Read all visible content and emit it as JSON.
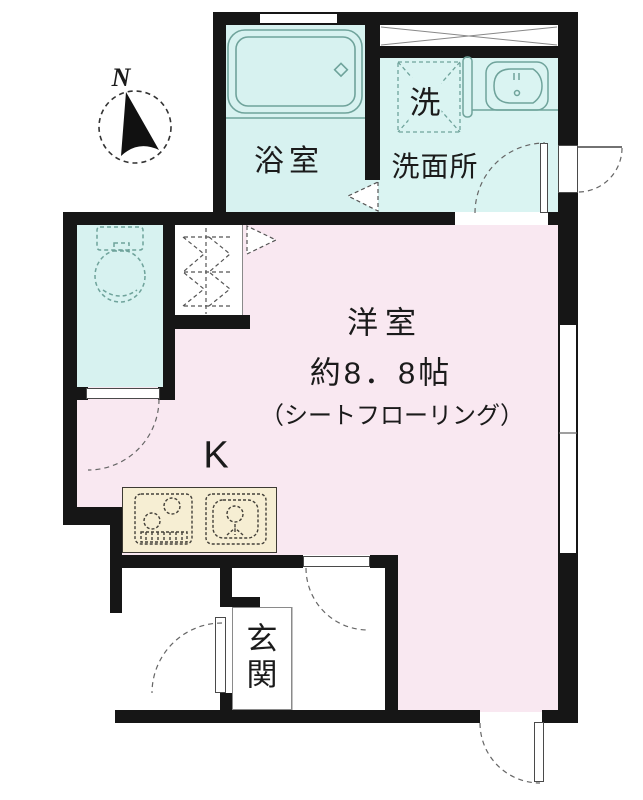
{
  "plan": {
    "compass_label": "N",
    "bathroom_label": "浴室",
    "washer_label": "洗",
    "washroom_label": "洗面所",
    "room_name": "洋室",
    "room_size": "約8．8帖",
    "room_flooring": "（シートフローリング）",
    "kitchen_label": "K",
    "entrance_label": "玄関"
  },
  "colors": {
    "wall": "#161616",
    "bath": "#d7f2f0",
    "washroom": "#daf4f2",
    "toilet": "#d7f2f0",
    "room": "#f9e8f1",
    "counter": "#f6eed3",
    "fixture": "#6fa39b",
    "arc": "#666666",
    "text": "#1b1b1b",
    "thin": "#8a8a8a"
  }
}
